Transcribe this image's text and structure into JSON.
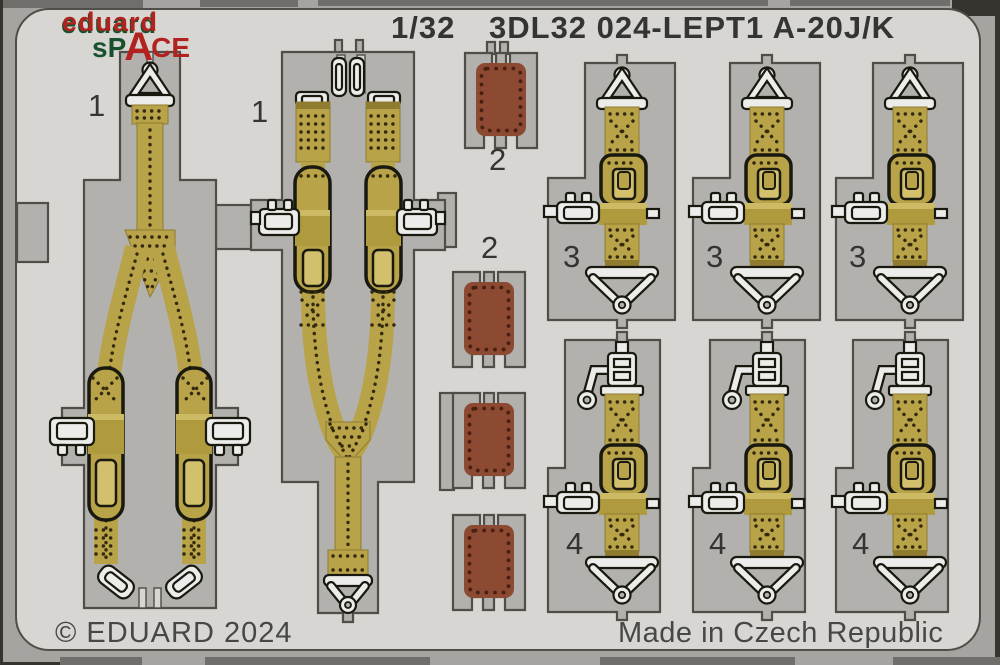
{
  "header": {
    "brand": "eduard",
    "brand_space_sp": "sP",
    "brand_space_a": "A",
    "brand_space_ce": "CE",
    "scale": "1/32",
    "product_code": "3DL32 024-LEPT1 A-20J/K"
  },
  "footer": {
    "copyright": "© EDUARD 2024",
    "origin": "Made in Czech Republic"
  },
  "part_labels": {
    "p1a": "1",
    "p1b": "1",
    "p2a": "2",
    "p2b": "2",
    "p3a": "3",
    "p3b": "3",
    "p3c": "3",
    "p4a": "4",
    "p4b": "4",
    "p4c": "4"
  },
  "colors": {
    "sheet": "#d7d6d2",
    "frame": "#a5a4a0",
    "edgebar": "#6f6e6a",
    "edgedark": "#35342f",
    "plate": "#b2b1ad",
    "outline": "#4f4e49",
    "outline2": "#191910",
    "strap": "#b8a348",
    "straplight": "#d2c06c",
    "strapdark": "#8f7c30",
    "block": "#b09a3e",
    "stitch": "#33290e",
    "metal": "#ececea",
    "hole": "#a5a4a0",
    "pad": "#8d4a33",
    "paddot": "#491f12",
    "textdark": "#343431",
    "textmid": "#474744",
    "logored": "#b2231f",
    "logogreen": "#19512f"
  }
}
